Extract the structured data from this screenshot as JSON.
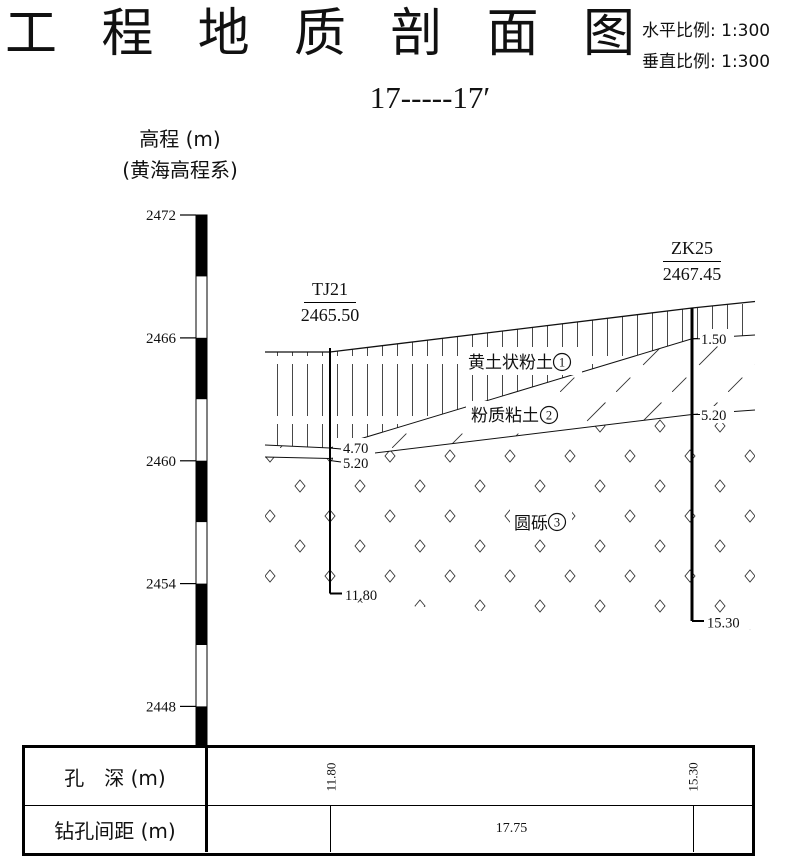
{
  "header": {
    "title": "工程地质剖面图",
    "title_chars": [
      "工",
      "程",
      "地",
      "质",
      "剖",
      "面",
      "图"
    ],
    "scale_h": "水平比例: 1:300",
    "scale_v": "垂直比例: 1:300",
    "section_label": "17-----17′"
  },
  "axis": {
    "title_line1": "高程 (m)",
    "title_line2": "(黄海高程系)",
    "unit": "m",
    "datum": "黄海高程系",
    "ticks": [
      "2472",
      "2466",
      "2460",
      "2454",
      "2448"
    ]
  },
  "boreholes": [
    {
      "name": "TJ21",
      "elevation": "2465.50",
      "marks": [
        "4.70",
        "5.20",
        "11.80"
      ],
      "hole_depth": "11.80"
    },
    {
      "name": "ZK25",
      "elevation": "2467.45",
      "marks": [
        "1.50",
        "5.20",
        "15.30"
      ],
      "hole_depth": "15.30"
    }
  ],
  "layers": [
    {
      "name": "黄土状粉土",
      "number": "1",
      "hatch": "vertical-lines"
    },
    {
      "name": "粉质粘土",
      "number": "2",
      "hatch": "diagonal-lines"
    },
    {
      "name": "圆砾",
      "number": "3",
      "hatch": "diamonds"
    }
  ],
  "table": {
    "rows": [
      {
        "label": "孔　深 (m)",
        "values": [
          "11.80",
          "15.30"
        ]
      },
      {
        "label": "钻孔间距 (m)",
        "values": [
          "17.75"
        ]
      }
    ]
  },
  "colors": {
    "line": "#111111",
    "hatch": "#333333",
    "background": "#ffffff"
  }
}
